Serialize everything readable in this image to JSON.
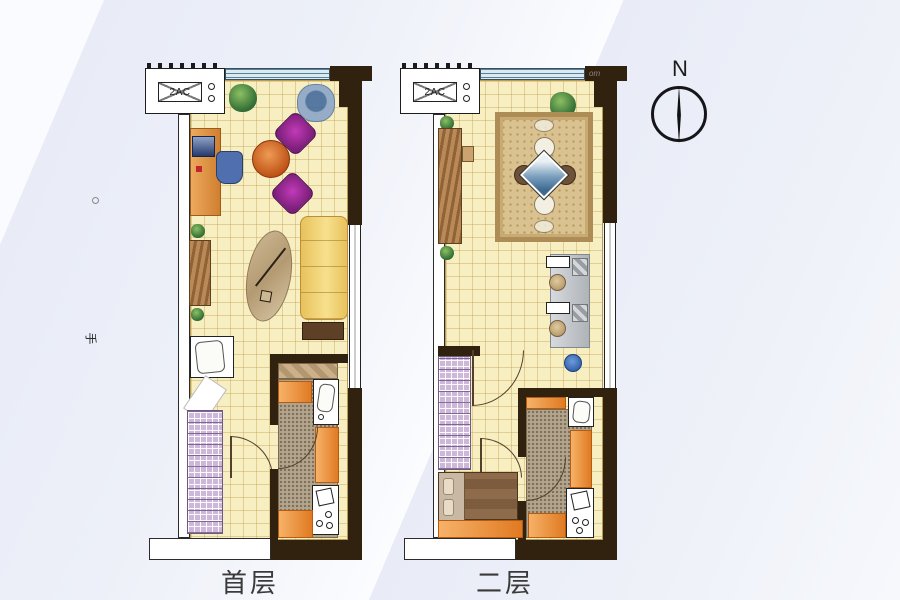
{
  "labels": {
    "floor1": "首层",
    "floor2": "二层"
  },
  "compass": {
    "label": "N"
  },
  "watermark": {
    "side_glyph": "手",
    "corner_text": "om"
  },
  "floors": [
    {
      "label": "首层",
      "ac_label": "2AC",
      "items": [
        "ac-platform",
        "bay-window",
        "potted-plant",
        "corner-armchair",
        "lounge-chair",
        "lounge-chair",
        "round-coffee-table",
        "computer-desk",
        "desk-chair",
        "computer-monitor",
        "bookshelf-cabinet",
        "potted-plant",
        "potted-plant",
        "oval-rug",
        "floor-lamp",
        "sofa",
        "side-table",
        "wash-basin",
        "staircase",
        "entry-door",
        "bathroom-door",
        "shower",
        "kitchen-sink",
        "counter",
        "stove"
      ]
    },
    {
      "label": "二层",
      "ac_label": "2AC",
      "items": [
        "ac-platform",
        "bay-window",
        "potted-plant",
        "dining-rug",
        "dining-table",
        "dining-chair",
        "dining-chair",
        "dining-chair",
        "dining-chair",
        "sideboard-cabinet",
        "potted-plant",
        "potted-plant",
        "workstation-desk",
        "desk-chair",
        "desk-chair",
        "waste-bin",
        "staircase",
        "room-door",
        "room-door",
        "bathroom-door",
        "bathroom-sink",
        "counter",
        "washing-machine",
        "bed"
      ]
    }
  ],
  "colors": {
    "wall": "#31210f",
    "floor_tile": "#f7eec2",
    "window": "#d9eaf3",
    "stairs": "#cdb8da",
    "counter_orange": "#e07a22",
    "carpet": "#d9c28f",
    "sofa": "#f2d979",
    "chair_purple": "#8e2a8b",
    "table_orange": "#cf5c1f",
    "background": "#eaedf7"
  }
}
